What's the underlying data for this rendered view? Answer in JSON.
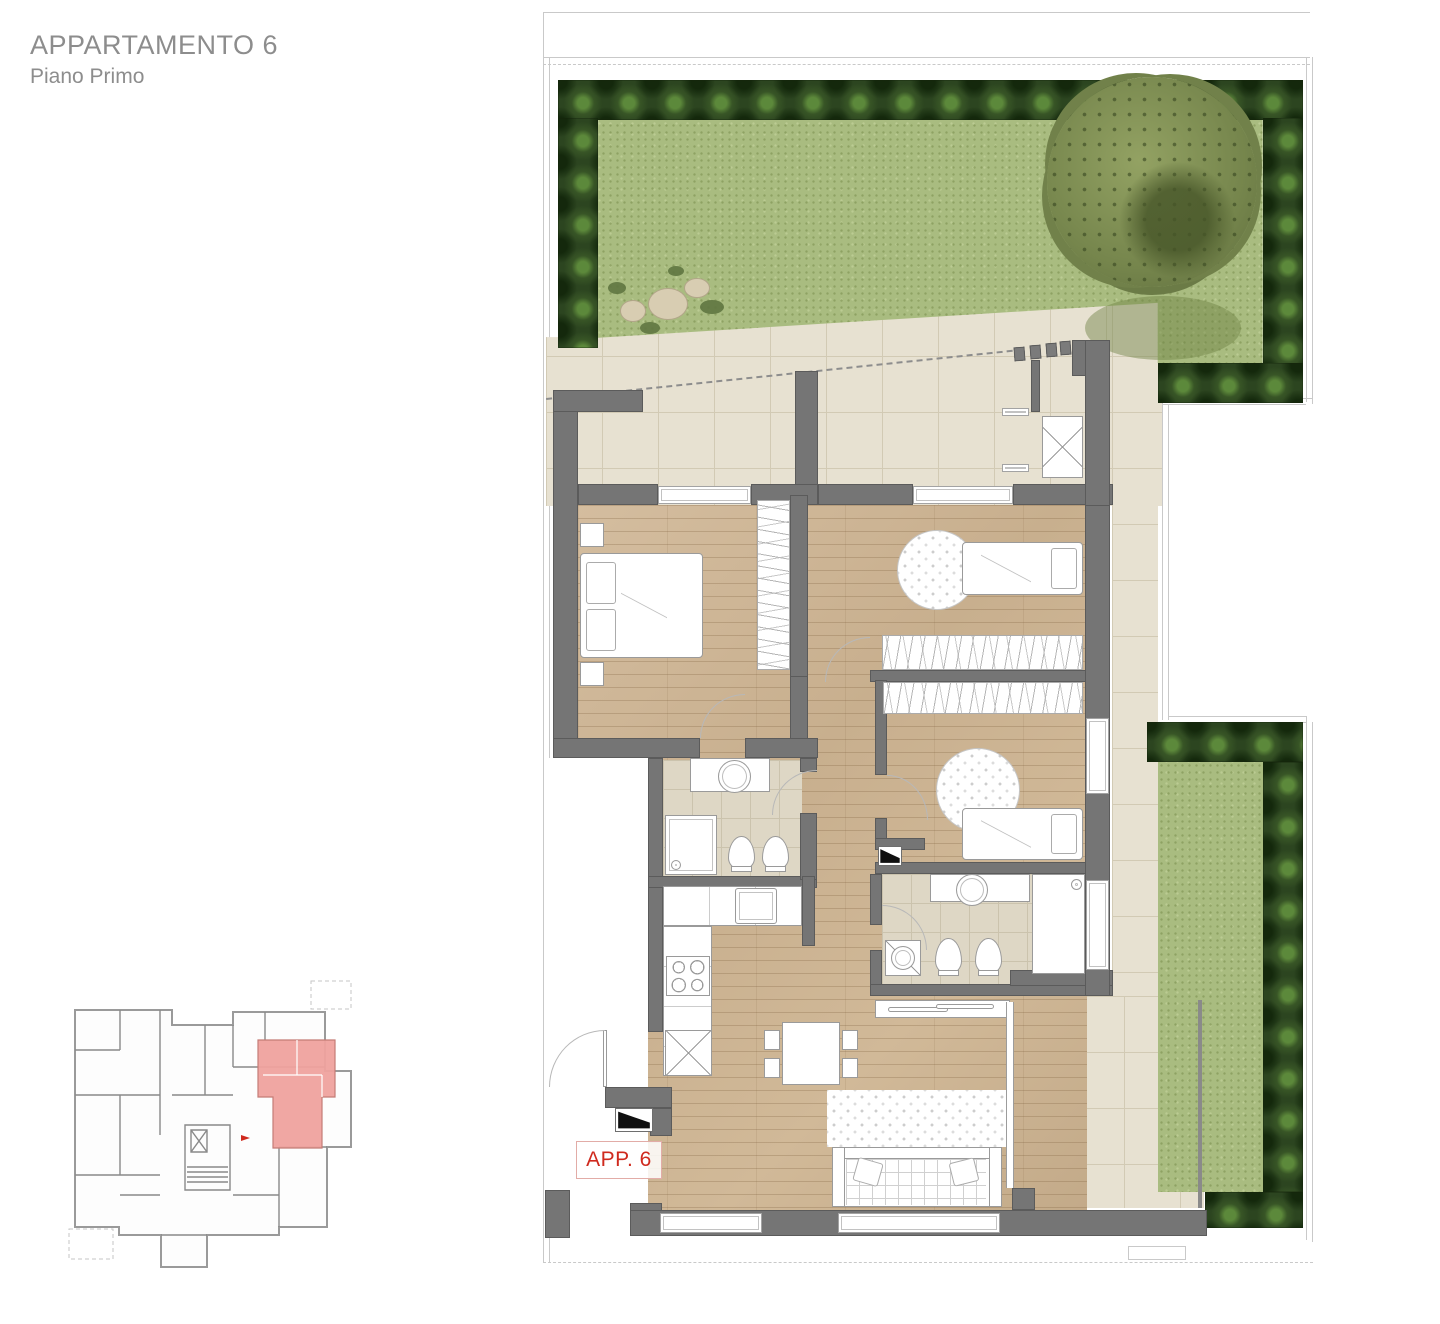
{
  "page": {
    "title": "APPARTAMENTO 6",
    "subtitle": "Piano Primo"
  },
  "plan": {
    "apartment_label": "APP. 6",
    "highlighted_unit": "Appartamento 6",
    "floor": "Piano Primo"
  },
  "palette": {
    "wall": "#757575",
    "lawn": "#a9bc80",
    "hedge": "#2c4520",
    "tile": "#e7e1d1",
    "bath_tile": "#ded7c5",
    "wood": "#cdb595",
    "pink": "#efa29e",
    "red": "#cf2a1e",
    "text_gray": "#8d8d8d",
    "boundary": "#c9c9c9"
  }
}
